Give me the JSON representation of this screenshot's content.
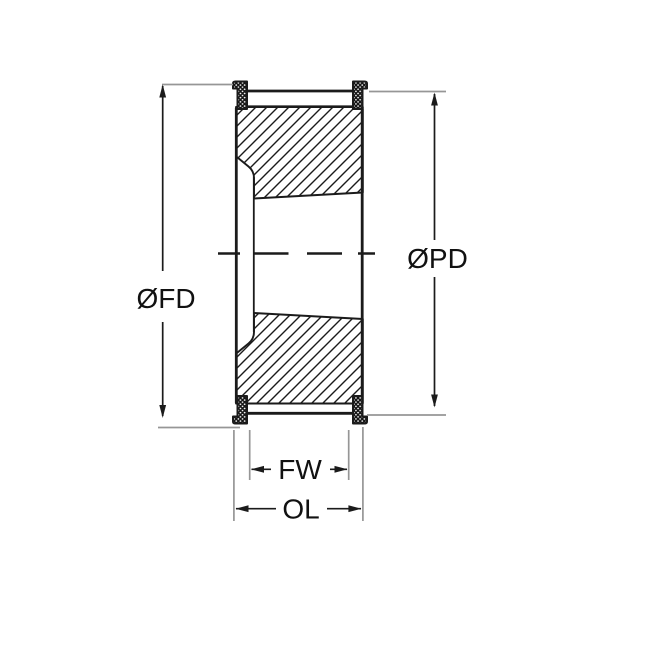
{
  "diagram": {
    "title": "Timing pulley cross-section technical drawing",
    "type": "technical-drawing",
    "dimension_labels": {
      "flange_diameter": "ØFD",
      "pitch_diameter": "ØPD",
      "face_width": "FW",
      "overall_length": "OL"
    },
    "colors": {
      "line": "#1b1b1b",
      "extension_line": "#969696",
      "background": "#ffffff",
      "label_text": "#111111"
    }
  }
}
